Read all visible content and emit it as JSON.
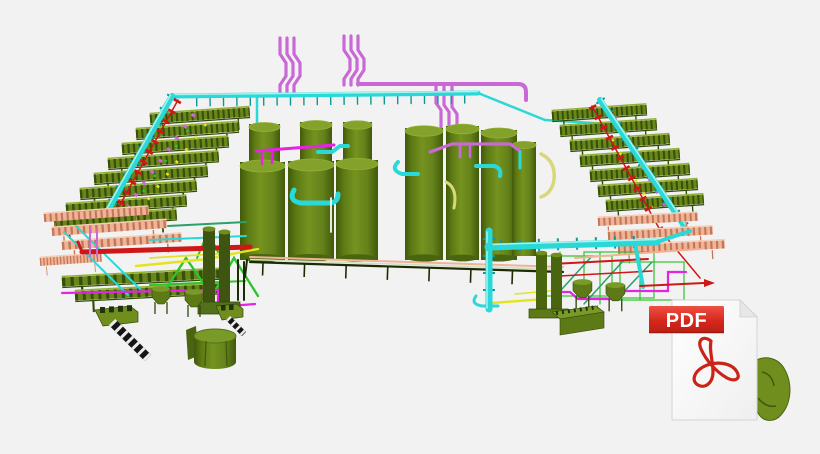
{
  "scene": {
    "name": "3D plant piping model",
    "description": "Isometric 3D CAD rendering of a process plant: rows of green storage tanks, cascaded air-cooler rack arrays left and right, an overhead cyan header pipe, magenta riser pipes, salmon cooler racks and multicolored process piping, with a PDF file badge overlapping the lower right of the model.",
    "components": [
      "magenta-riser-pipes",
      "cyan-header-pipe",
      "left-cooler-rack-array",
      "right-cooler-rack-array",
      "left-salmon-racks",
      "right-salmon-racks",
      "storage-tanks",
      "tank-piping",
      "left-process-cluster",
      "right-process-cluster",
      "bottom-rack-pipe",
      "ground-equipment",
      "pdf-file-icon"
    ]
  },
  "palette": {
    "background": "#f2f2f2",
    "tank-green": "#6b8a1b",
    "tank-green-light": "#83a12b",
    "tank-green-dark": "#4a650f",
    "rack-olive": "#6a8619",
    "rack-olive-dark": "#35500a",
    "rack-olive-light": "#93b135",
    "rack-salmon": "#efb396",
    "rack-salmon-dark": "#c4765a",
    "pipe-cyan": "#2bd8d8",
    "pipe-cyan-dark": "#0d9898",
    "pipe-cyan-light": "#a8f4ef",
    "pipe-orchid": "#c969d6",
    "pipe-magenta": "#e523e5",
    "pipe-red": "#cf1717",
    "pipe-yellow": "#e3e31f",
    "pipe-lime": "#2ec42e",
    "pipe-seagreen": "#2aa06a",
    "pipe-khaki": "#d8d87a",
    "pipe-dark": "#1c2b04",
    "metal-dark-olive": "#3d5510",
    "pdf-banner": "#d6281c",
    "pdf-banner-dark": "#9f1b12",
    "pdf-page": "#fbfbfb",
    "pdf-page-edge": "#d4d4d4",
    "pdf-swirl": "#cb2318",
    "pdf-text": "#ffffff"
  },
  "pdf_badge": {
    "label": "PDF"
  }
}
